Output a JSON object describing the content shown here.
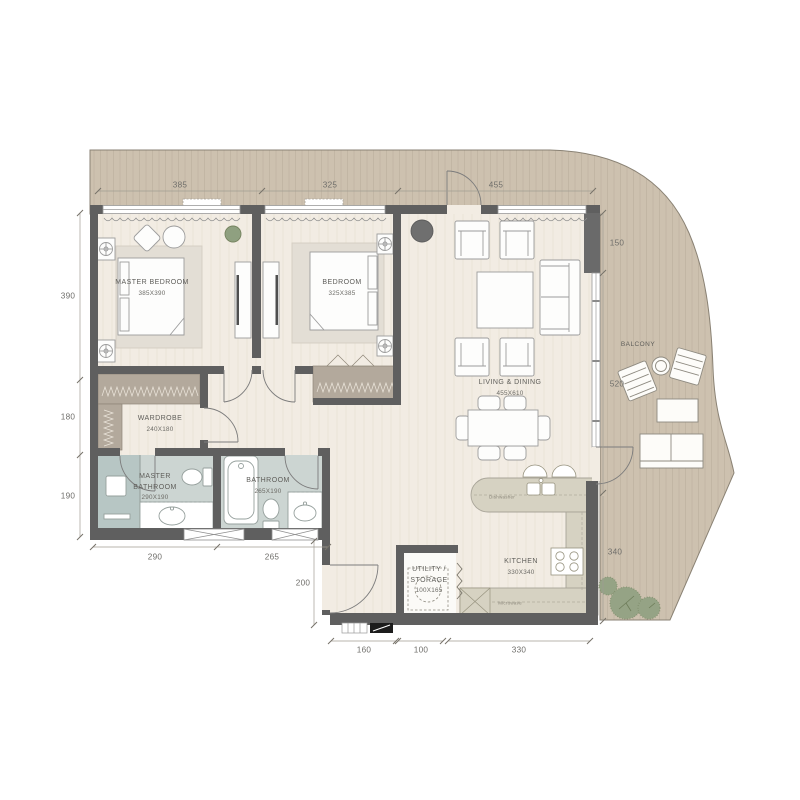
{
  "rooms": {
    "master_bedroom": {
      "name": "MASTER BEDROOM",
      "size": "385X390"
    },
    "bedroom": {
      "name": "BEDROOM",
      "size": "325X385"
    },
    "wardrobe": {
      "name": "WARDROBE",
      "size": "240X180"
    },
    "master_bathroom": {
      "name": "MASTER BATHROOM",
      "size": "290X190"
    },
    "bathroom": {
      "name": "BATHROOM",
      "size": "265X190"
    },
    "living_dining": {
      "name": "LIVING & DINING",
      "size": "455X610"
    },
    "kitchen": {
      "name": "KITCHEN",
      "size": "330X340"
    },
    "utility": {
      "name": "UTILITY / STORAGE",
      "size": "100X165"
    },
    "balcony": {
      "name": "BALCONY"
    }
  },
  "appliances": {
    "dishwasher": "Dishwasher",
    "microwave": "Microwave"
  },
  "dimensions": {
    "top": [
      "385",
      "325",
      "455"
    ],
    "left": [
      "390",
      "180",
      "190"
    ],
    "right": [
      "150",
      "520",
      "340"
    ],
    "bathroom_bottom": [
      "290",
      "265"
    ],
    "entry_side": "200",
    "bottom": [
      "160",
      "100",
      "330"
    ]
  },
  "colors": {
    "wall": "#5f5f5f",
    "deck": "#cdc1af",
    "floor": "#f2ece3",
    "bathroom_floor": "#ccd5d2",
    "shower": "#b7c6c4",
    "counter": "#d6d2c2",
    "closet": "#b3a99c",
    "greenery": "#95a385"
  }
}
